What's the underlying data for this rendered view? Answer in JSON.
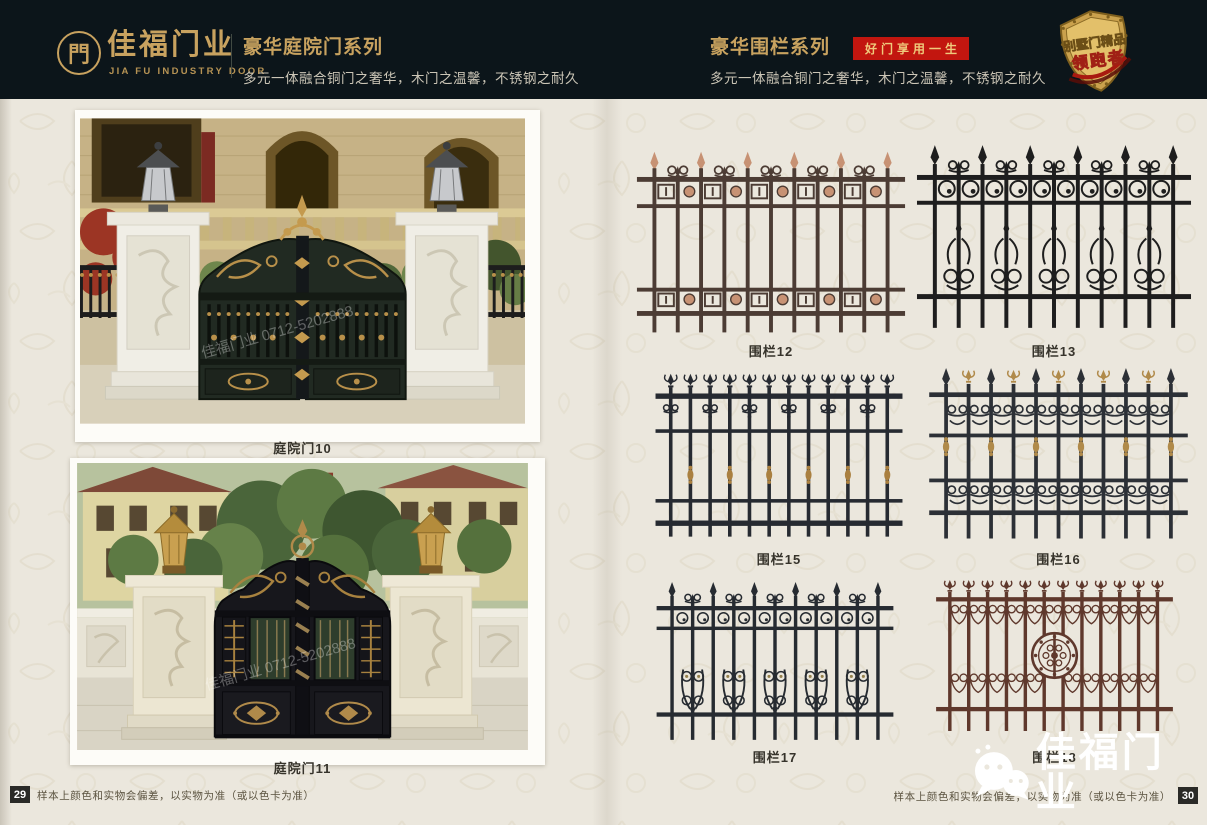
{
  "header": {
    "logo": {
      "symbol": "門",
      "name": "佳福门业",
      "name_en": "JIA FU INDUSTRY DOOR"
    },
    "left_series": {
      "title": "豪华庭院门系列",
      "subtitle": "多元一体融合铜门之奢华，木门之温馨，不锈钢之耐久"
    },
    "right_series": {
      "title": "豪华围栏系列",
      "badge": "好门享用一生",
      "subtitle": "多元一体融合铜门之奢华，木门之温馨，不锈钢之耐久"
    },
    "emblem": {
      "line1": "别墅门精品",
      "line2": "领跑者"
    },
    "colors": {
      "background": "#0c151a",
      "gold": "#c8a25f",
      "badge_red": "#c2160f",
      "badge_text": "#efca7c"
    }
  },
  "left_page": {
    "photos": [
      {
        "caption": "庭院门10",
        "watermark": "佳福门业 0712-5202888"
      },
      {
        "caption": "庭院门11",
        "watermark": "佳福门业 0712-5202888"
      }
    ],
    "footer": {
      "page_number": "29",
      "disclaimer": "样本上颜色和实物会偏差，以实物为准（或以色卡为准）"
    }
  },
  "right_page": {
    "fences": [
      {
        "label": "围栏12",
        "style": "greek",
        "color": "#4c3c34",
        "accent": "#c79274"
      },
      {
        "label": "围栏13",
        "style": "circles",
        "color": "#1e1e1e",
        "accent": "#3a3a3a"
      },
      {
        "label": "围栏15",
        "style": "fleur",
        "color": "#262a31",
        "accent": "#aa8040"
      },
      {
        "label": "围栏16",
        "style": "goldscroll",
        "color": "#2c3036",
        "accent": "#b08a4a"
      },
      {
        "label": "围栏17",
        "style": "scrollband",
        "color": "#262b31",
        "accent": "#94804d"
      },
      {
        "label": "围栏18",
        "style": "medallion",
        "color": "#5f382c",
        "accent": "#8a5240"
      }
    ],
    "footer": {
      "page_number": "30",
      "disclaimer": "样本上颜色和实物会偏差，以实物为准（或以色卡为准）"
    }
  },
  "watermark_logo": {
    "text": "佳福门业"
  }
}
